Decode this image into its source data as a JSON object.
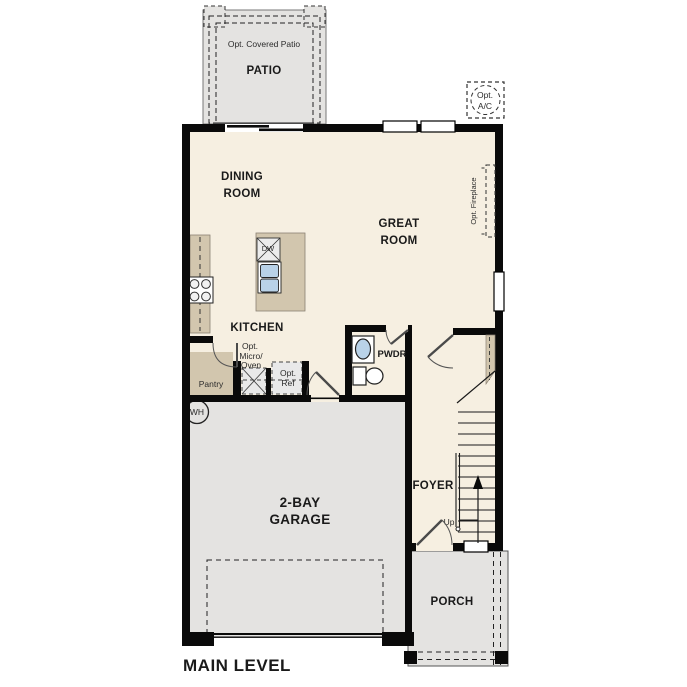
{
  "title": "MAIN LEVEL",
  "colors": {
    "floor_cream": "#f6efe1",
    "concrete_gray": "#e4e3e1",
    "counter_tan": "#d2c6ae",
    "wall_black": "#0a0a0a",
    "sink_blue": "#b9d2e8"
  },
  "rooms": {
    "dining": {
      "line1": "DINING",
      "line2": "ROOM"
    },
    "great": {
      "line1": "GREAT",
      "line2": "ROOM"
    },
    "kitchen": {
      "label": "KITCHEN"
    },
    "pwdr": {
      "label": "PWDR"
    },
    "pantry": {
      "label": "Pantry"
    },
    "foyer": {
      "label": "FOYER"
    },
    "garage": {
      "line1": "2-BAY",
      "line2": "GARAGE"
    },
    "porch": {
      "label": "PORCH"
    },
    "patio": {
      "label": "PATIO"
    }
  },
  "annotations": {
    "covered_patio": "Opt. Covered Patio",
    "ac_line1": "Opt.",
    "ac_line2": "A/C",
    "fireplace": "Opt. Fireplace",
    "micro_line1": "Opt.",
    "micro_line2": "Micro/",
    "micro_line3": "Oven",
    "ref_line1": "Opt.",
    "ref_line2": "Ref",
    "dw": "DW",
    "wh": "WH",
    "up": "Up"
  }
}
